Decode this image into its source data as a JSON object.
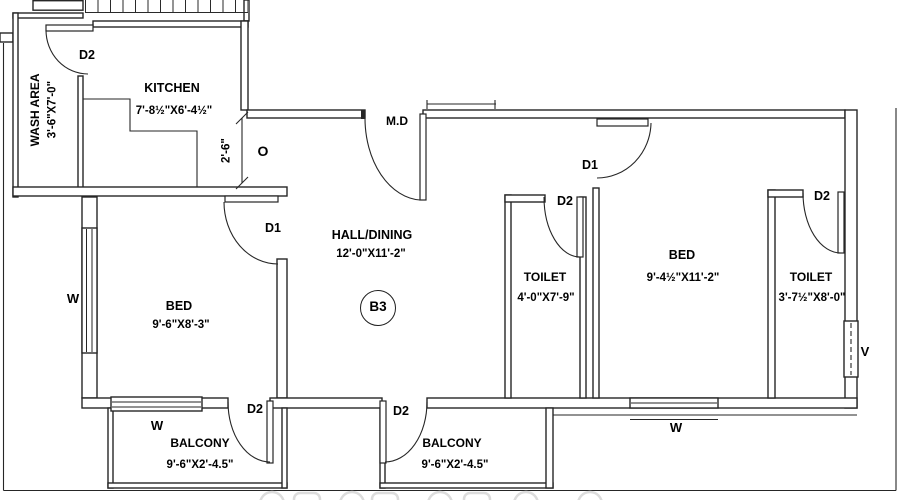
{
  "unit": "B3",
  "rooms": {
    "wash_area": {
      "name": "WASH AREA",
      "dims": "3'-6\"X7'-0\""
    },
    "kitchen": {
      "name": "KITCHEN",
      "dims": "7'-8½\"X6'-4½\""
    },
    "hall": {
      "name": "HALL/DINING",
      "dims": "12'-0\"X11'-2\""
    },
    "bed_left": {
      "name": "BED",
      "dims": "9'-6\"X8'-3\""
    },
    "toilet_mid": {
      "name": "TOILET",
      "dims": "4'-0\"X7'-9\""
    },
    "bed_right": {
      "name": "BED",
      "dims": "9'-4½\"X11'-2\""
    },
    "toilet_right": {
      "name": "TOILET",
      "dims": "3'-7½\"X8'-0\""
    },
    "balcony_left": {
      "name": "BALCONY",
      "dims": "9'-6\"X2'-4.5\""
    },
    "balcony_right": {
      "name": "BALCONY",
      "dims": "9'-6\"X2'-4.5\""
    }
  },
  "labels": {
    "main_door": "M.D",
    "door_d1": "D1",
    "door_d2": "D2",
    "window": "W",
    "ventilator": "V",
    "opening": "O",
    "opening_dim": "2'-6\""
  },
  "colors": {
    "line": "#262626",
    "text": "#000000",
    "background": "#ffffff",
    "watermark": "#dcdcdc"
  }
}
